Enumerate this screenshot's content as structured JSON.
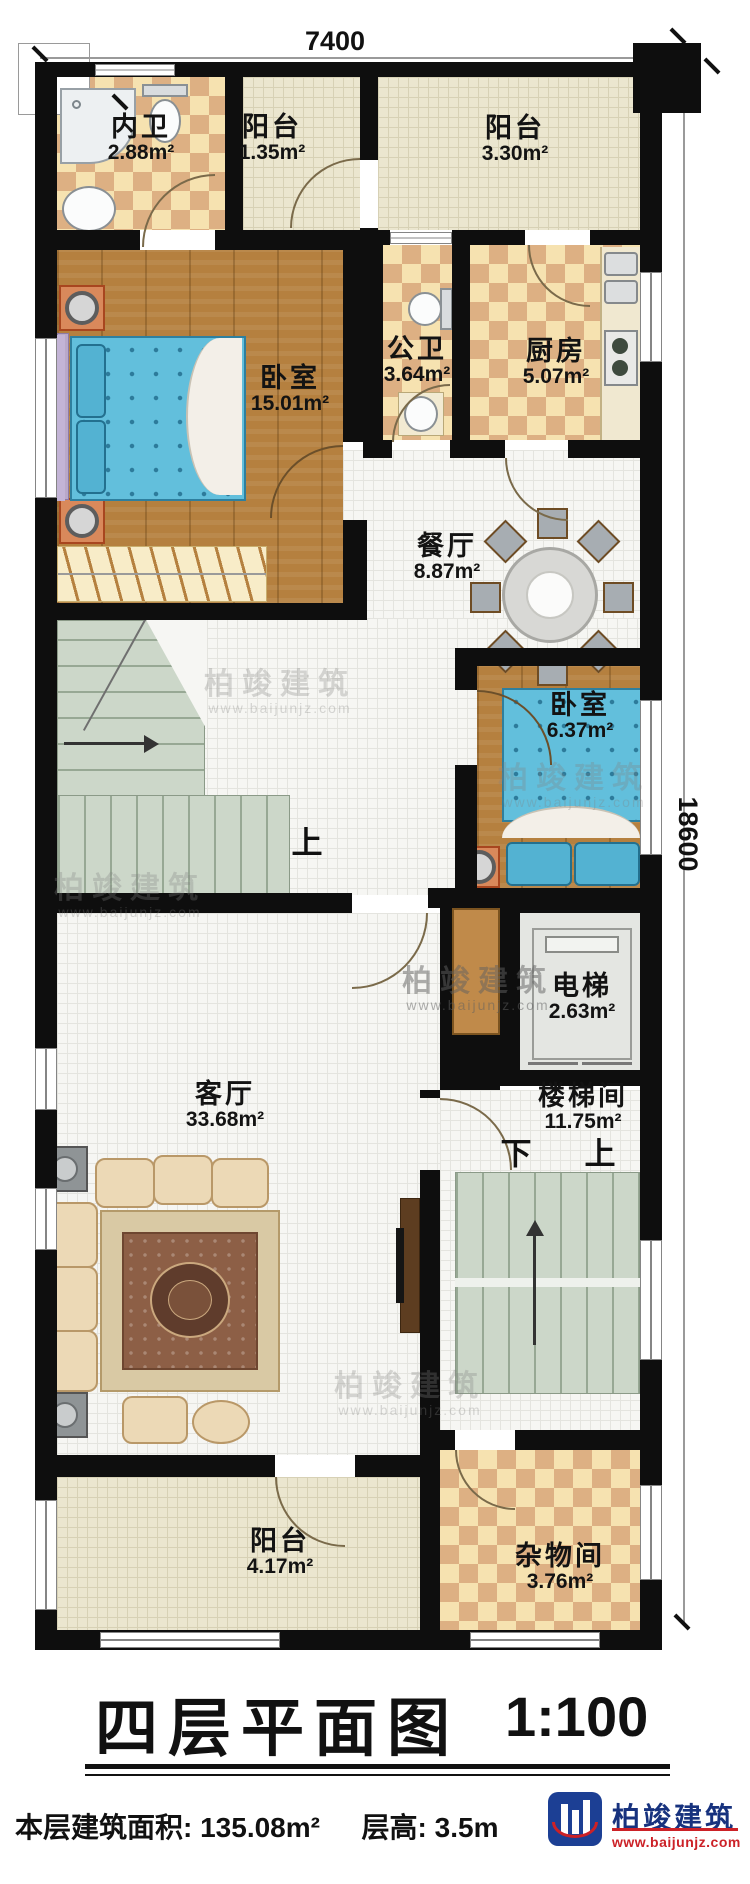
{
  "plan": {
    "dimensions": {
      "top": "7400",
      "right": "18600"
    },
    "rooms": [
      {
        "name": "内卫",
        "area": "2.88m²"
      },
      {
        "name": "阳台",
        "area": "1.35m²"
      },
      {
        "name": "阳台",
        "area": "3.30m²"
      },
      {
        "name": "卧室",
        "area": "15.01m²"
      },
      {
        "name": "公卫",
        "area": "3.64m²"
      },
      {
        "name": "厨房",
        "area": "5.07m²"
      },
      {
        "name": "餐厅",
        "area": "8.87m²"
      },
      {
        "name": "卧室",
        "area": "6.37m²"
      },
      {
        "name": "电梯",
        "area": "2.63m²"
      },
      {
        "name": "楼梯间",
        "area": "11.75m²"
      },
      {
        "name": "客厅",
        "area": "33.68m²"
      },
      {
        "name": "阳台",
        "area": "4.17m²"
      },
      {
        "name": "杂物间",
        "area": "3.76m²"
      }
    ],
    "stair_labels": {
      "mid_up": "上",
      "lower_down": "下",
      "lower_up": "上"
    },
    "title": {
      "name": "四层平面图",
      "scale": "1:100"
    },
    "summary": {
      "floor_area_label": "本层建筑面积:",
      "floor_area_value": "135.08m²",
      "floor_height_label": "层高:",
      "floor_height_value": "3.5m"
    },
    "brand": {
      "name": "柏竣建筑",
      "website": "www.baijunjz.com"
    },
    "watermark": {
      "name": "柏竣建筑",
      "website": "www.baijunjz.com"
    },
    "colors": {
      "wall": "#0e0e0e",
      "wood_floor": "#b5803f",
      "tile_light": "#f6e2b0",
      "tile_dark": "#ddb083",
      "bed_blue": "#62bfdc",
      "stair_green": "#ccd7c9",
      "brand_blue": "#17327e",
      "brand_red": "#cc2127"
    }
  }
}
